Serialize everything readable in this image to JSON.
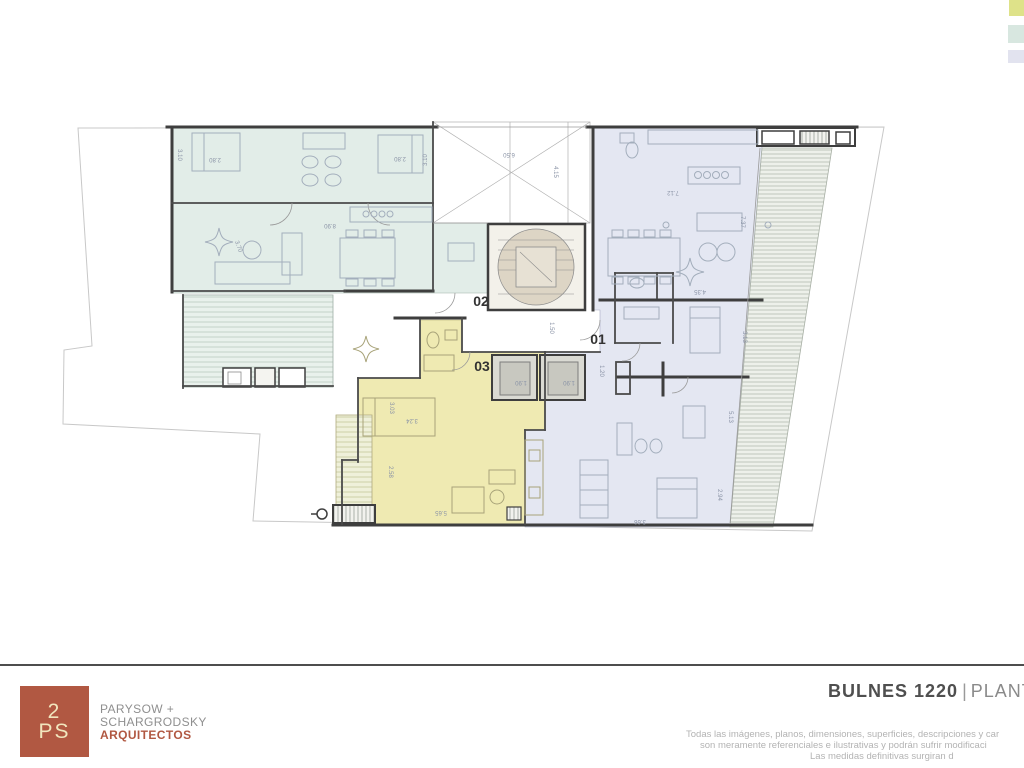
{
  "colors": {
    "unit01_fill": "#e4e7f2",
    "unit02_fill": "#e2ede8",
    "unit03_fill": "#efeab2",
    "accent_terracotta": "#b15842",
    "swatch_yellow_green": "#dee289",
    "swatch_teal": "#d8e7e0",
    "swatch_lavender": "#e2e3ef"
  },
  "legend": {
    "swatches": [
      {
        "name": "yellow-green",
        "color": "#dee289"
      },
      {
        "name": "teal",
        "color": "#d8e7e0"
      },
      {
        "name": "lavender",
        "color": "#e2e3ef"
      }
    ]
  },
  "plan": {
    "units": [
      {
        "id": "01",
        "color": "#e4e7f2"
      },
      {
        "id": "02",
        "color": "#e2ede8"
      },
      {
        "id": "03",
        "color": "#efeab2"
      }
    ],
    "dims": [
      "2.80",
      "3.10",
      "2.80",
      "3.10",
      "8.90",
      "3.70",
      "6.50",
      "4.15",
      "7.12",
      "7.37",
      "4.35",
      "1.50",
      "1.90",
      "1.90",
      "1.20",
      "3.03",
      "3.24",
      "2.58",
      "5.65",
      "3.13",
      "5.13",
      "2.94",
      "3.66"
    ]
  },
  "footer": {
    "logo": {
      "line1": "2",
      "line2": "PS"
    },
    "firm": [
      "PARYSOW +",
      "SCHARGRODSKY",
      "ARQUITECTOS"
    ],
    "title": "BULNES 1220",
    "title_separator": "|",
    "title_suffix": "PLANT",
    "disclaimer": [
      "Todas las imágenes, planos, dimensiones, superficies, descripciones y car",
      "son meramente referenciales e ilustrativas y podrán sufrir modificaci",
      "Las medidas definitivas surgiran d"
    ]
  }
}
